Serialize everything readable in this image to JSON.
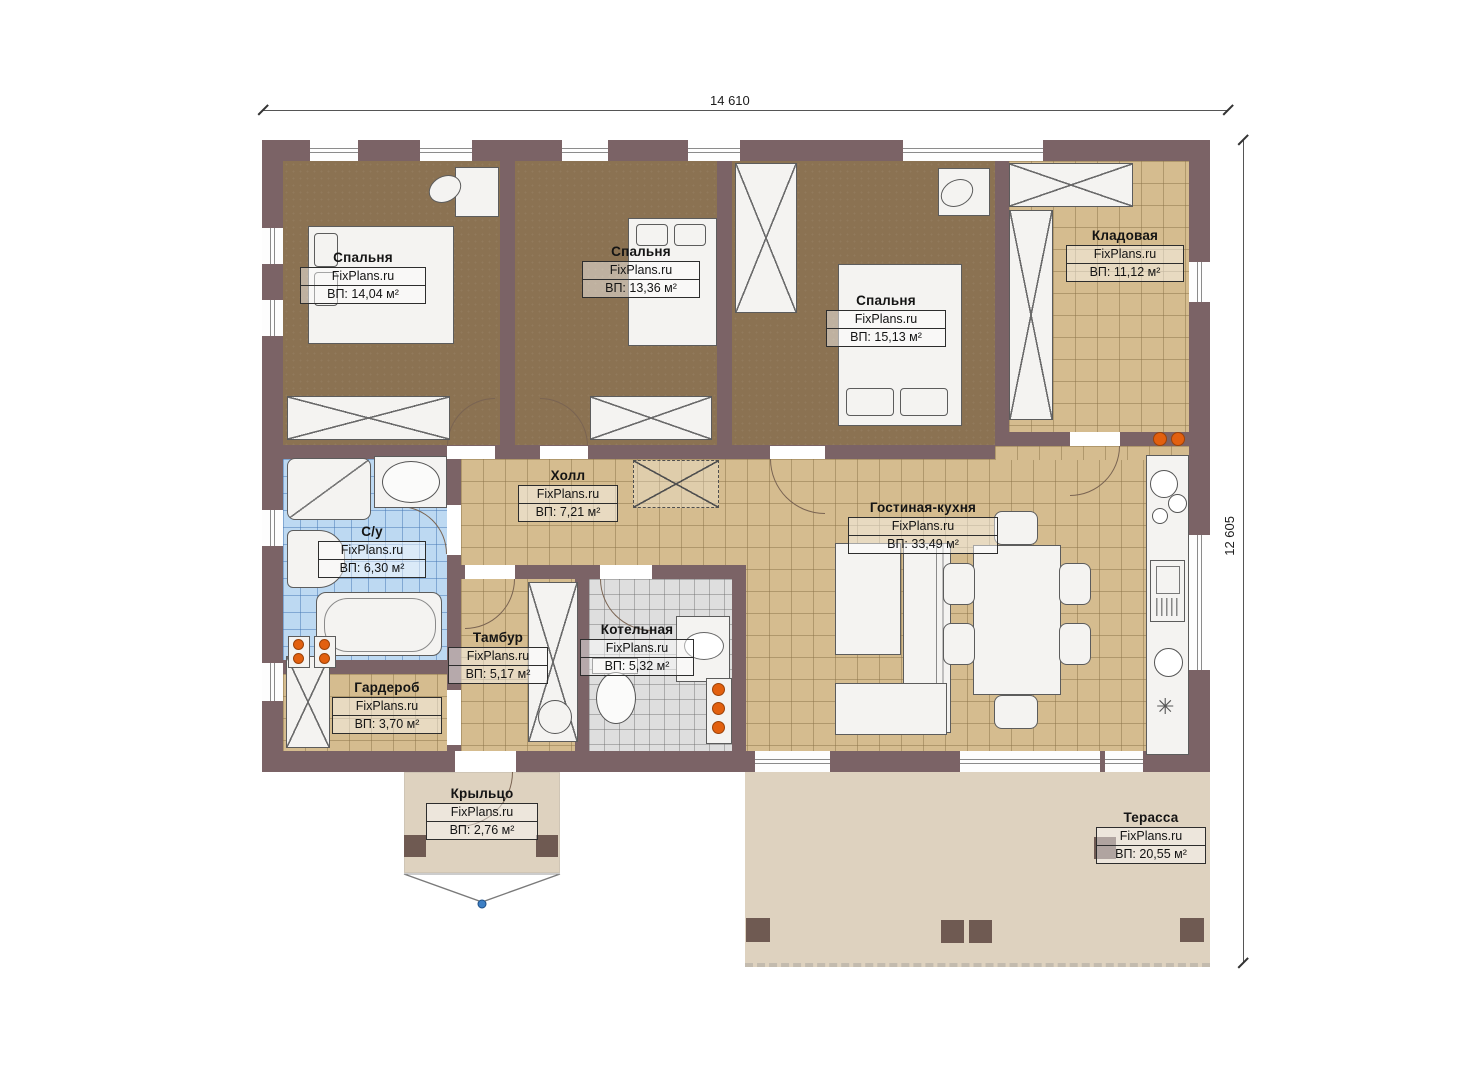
{
  "branding": "FixPlans.ru",
  "dimensions": {
    "width_label": "14 610",
    "height_label": "12 605"
  },
  "rooms": [
    {
      "name": "Спальня",
      "area": "ВП: 14,04 м²"
    },
    {
      "name": "Спальня",
      "area": "ВП: 13,36 м²"
    },
    {
      "name": "Спальня",
      "area": "ВП: 15,13 м²"
    },
    {
      "name": "Кладовая",
      "area": "ВП: 11,12 м²"
    },
    {
      "name": "Холл",
      "area": "ВП: 7,21 м²"
    },
    {
      "name": "С/у",
      "area": "ВП: 6,30 м²"
    },
    {
      "name": "Тамбур",
      "area": "ВП: 5,17 м²"
    },
    {
      "name": "Котельная",
      "area": "ВП: 5,32 м²"
    },
    {
      "name": "Гардероб",
      "area": "ВП: 3,70 м²"
    },
    {
      "name": "Гостиная-кухня",
      "area": "ВП: 33,49 м²"
    },
    {
      "name": "Крыльцо",
      "area": "ВП: 2,76 м²"
    },
    {
      "name": "Терасса",
      "area": "ВП: 20,55 м²"
    }
  ],
  "symbols": {
    "asterisk": "✳"
  },
  "colors": {
    "wall": "#7b6366",
    "bedroom_floor": "#8b7252",
    "tile_tan": "#d5bc8f",
    "tile_blue": "#bdd9f2",
    "tile_gray": "#dedede",
    "outdoor": "#ded2bf",
    "accent_orange": "#e2600f"
  }
}
